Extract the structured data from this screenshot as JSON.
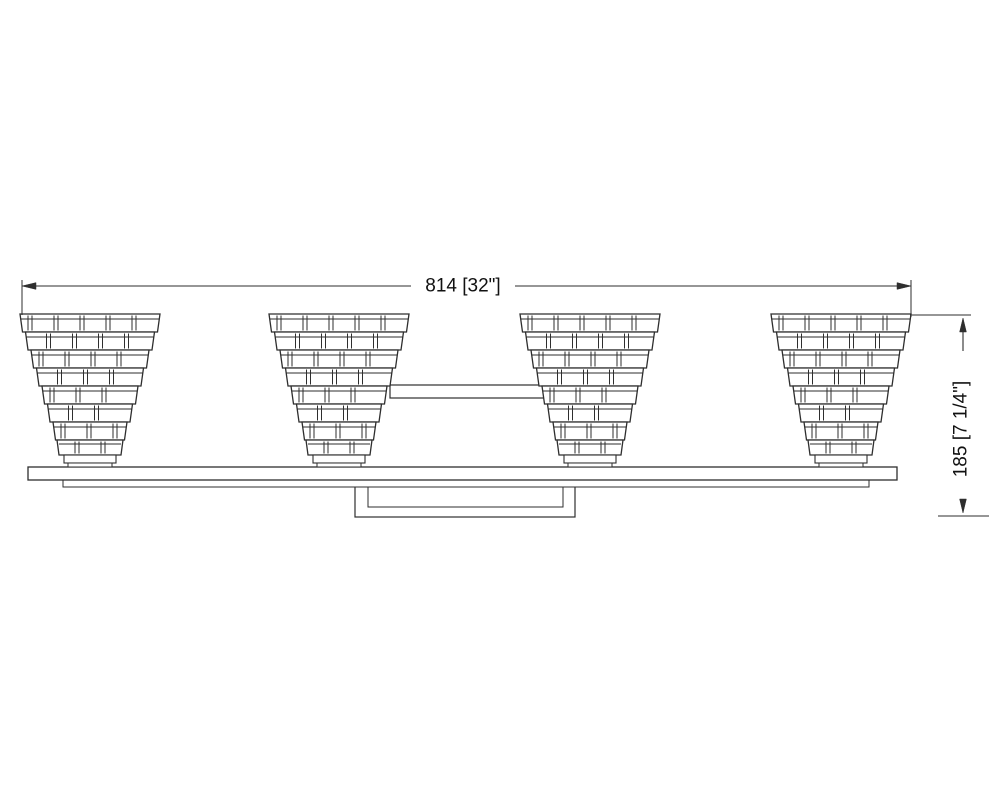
{
  "page": {
    "background": "#ffffff",
    "line_color": "#2e2e2e",
    "text_color": "#111111"
  },
  "drawing": {
    "subject": "4-light bath vanity fixture, front elevation line drawing",
    "fixture": {
      "light_count": 4,
      "shade_style": "tiered stepped shades",
      "tiers_per_shade": 7
    },
    "dimensions": {
      "width": {
        "label": "814 [32\"]",
        "millimeters": 814,
        "inches": "32\""
      },
      "height": {
        "label": "185 [7 1/4\"]",
        "millimeters": 185,
        "inches": "7 1/4\""
      }
    }
  }
}
